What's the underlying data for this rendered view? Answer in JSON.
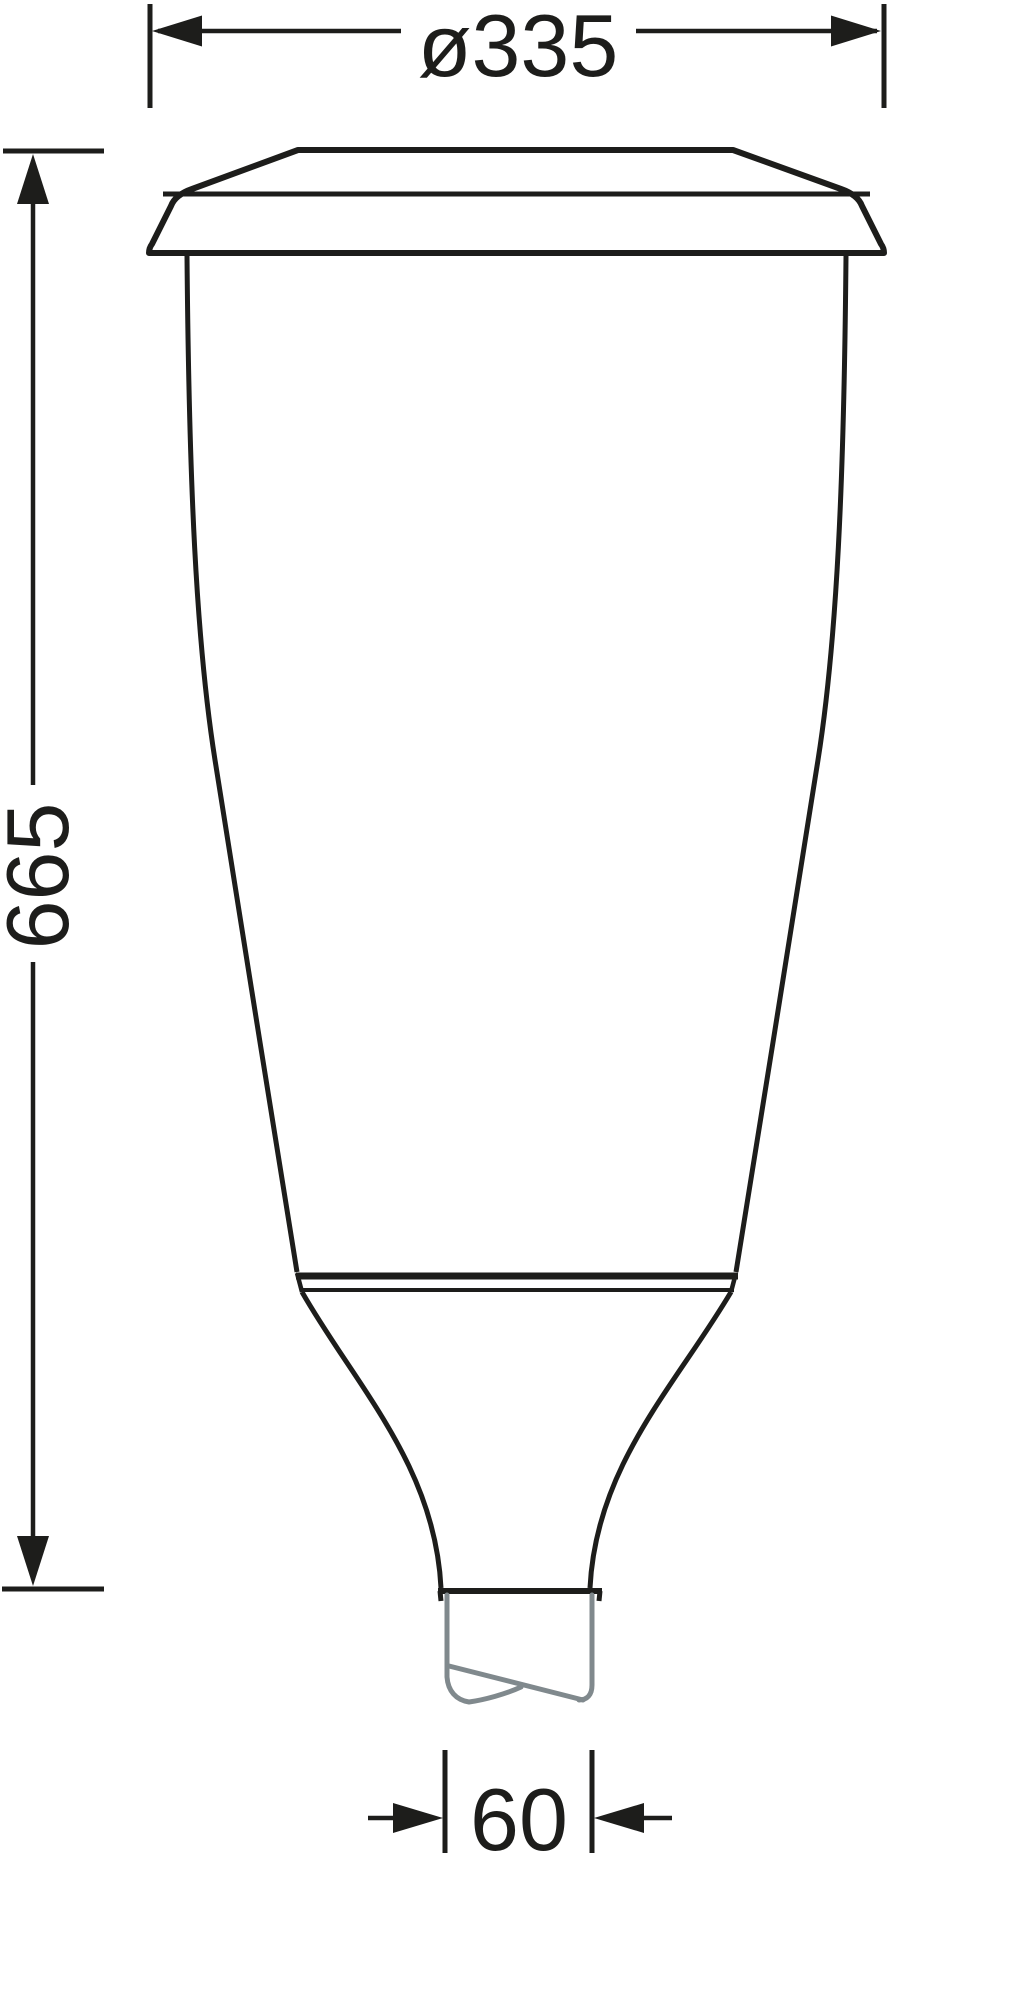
{
  "drawing": {
    "kind": "technical-dimension-drawing",
    "dimension_labels": {
      "top_diameter": "ø335",
      "overall_height": "665",
      "spigot_diameter": "60"
    },
    "colors": {
      "line": "#1d1d1b",
      "spigot_gray": "#80898d",
      "background": "#ffffff"
    }
  }
}
